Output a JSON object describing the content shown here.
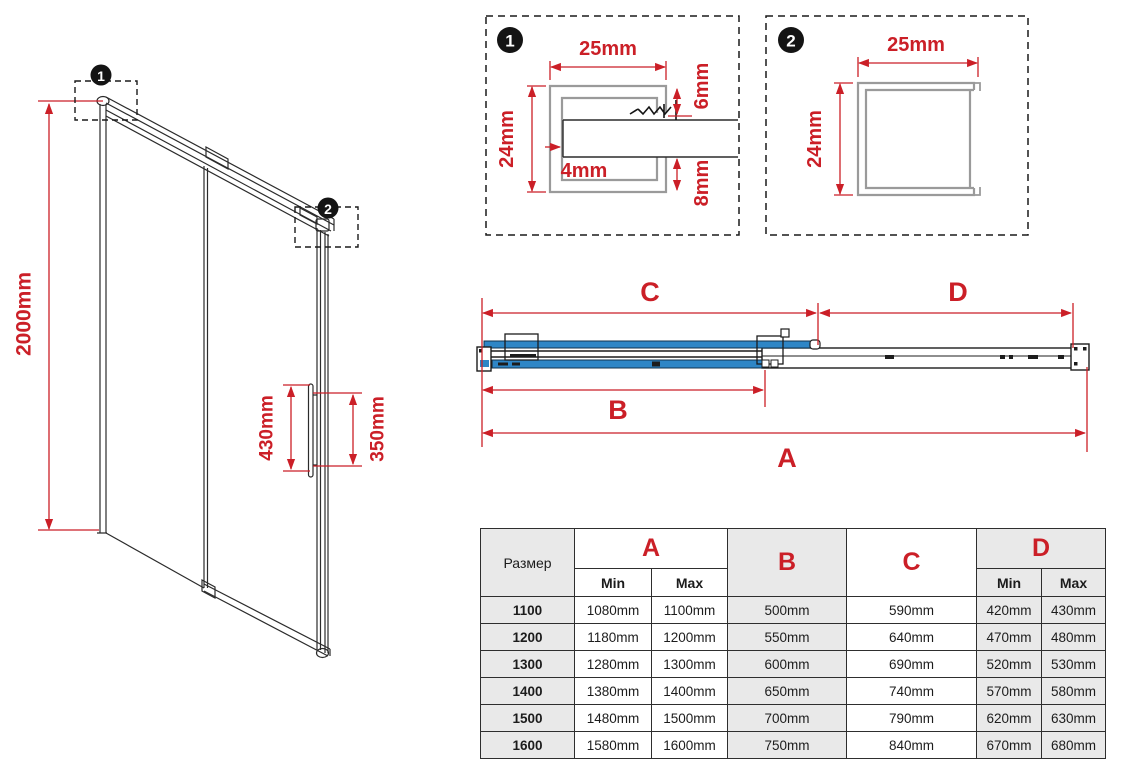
{
  "colors": {
    "dimension_red": "#CB1F27",
    "glass_blue": "#2E86C6",
    "table_gray": "#E9E9E9",
    "profile_gray": "#9A9A9A",
    "line_black": "#2b2b2b"
  },
  "markers": {
    "one": "1",
    "two": "2"
  },
  "iso_view": {
    "height_label": "2000mm",
    "handle_length_label": "430mm",
    "handle_holes_label": "350mm"
  },
  "detail_1": {
    "width_label": "25mm",
    "height_label": "24mm",
    "top_gap_label": "6mm",
    "wall_label": "4mm",
    "bottom_gap_label": "8mm"
  },
  "detail_2": {
    "width_label": "25mm",
    "height_label": "24mm"
  },
  "plan_view": {
    "dim_a": "A",
    "dim_b": "B",
    "dim_c": "C",
    "dim_d": "D"
  },
  "table": {
    "size_header": "Размер",
    "col_a": "A",
    "col_b": "B",
    "col_c": "C",
    "col_d": "D",
    "min_label": "Min",
    "max_label": "Max",
    "min_label_d": "Min",
    "max_label_d": "Max",
    "rows": [
      {
        "size": "1100",
        "a_min": "1080mm",
        "a_max": "1100mm",
        "b": "500mm",
        "c": "590mm",
        "d_min": "420mm",
        "d_max": "430mm"
      },
      {
        "size": "1200",
        "a_min": "1180mm",
        "a_max": "1200mm",
        "b": "550mm",
        "c": "640mm",
        "d_min": "470mm",
        "d_max": "480mm"
      },
      {
        "size": "1300",
        "a_min": "1280mm",
        "a_max": "1300mm",
        "b": "600mm",
        "c": "690mm",
        "d_min": "520mm",
        "d_max": "530mm"
      },
      {
        "size": "1400",
        "a_min": "1380mm",
        "a_max": "1400mm",
        "b": "650mm",
        "c": "740mm",
        "d_min": "570mm",
        "d_max": "580mm"
      },
      {
        "size": "1500",
        "a_min": "1480mm",
        "a_max": "1500mm",
        "b": "700mm",
        "c": "790mm",
        "d_min": "620mm",
        "d_max": "630mm"
      },
      {
        "size": "1600",
        "a_min": "1580mm",
        "a_max": "1600mm",
        "b": "750mm",
        "c": "840mm",
        "d_min": "670mm",
        "d_max": "680mm"
      }
    ]
  }
}
